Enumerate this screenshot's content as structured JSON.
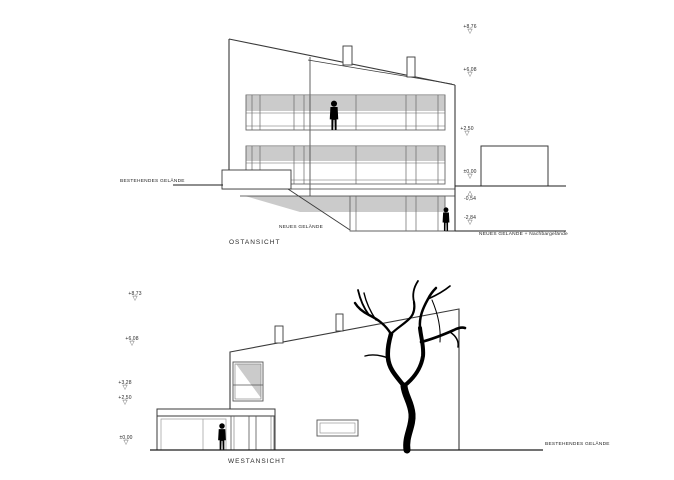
{
  "sheet": {
    "type": "architectural elevation drawings"
  },
  "glyphs": {
    "triangle_down": "▽",
    "triangle_up": "△"
  },
  "colors": {
    "background": "#ffffff",
    "line": "#444444",
    "shadow": "#cccccc",
    "silhouette": "#000000"
  },
  "east": {
    "title": "OSTANSICHT",
    "existing_ground_label": "BESTEHENDES GELÄNDE",
    "new_ground_label": "NEUES GELÄNDE",
    "new_ground_neighbor_label": "NEUES GELÄNDE + Nachbargelände",
    "markers": [
      {
        "value": "+8,76",
        "direction": "down"
      },
      {
        "value": "+6,08",
        "direction": "down"
      },
      {
        "value": "+2,50",
        "direction": "down"
      },
      {
        "value": "±0,00",
        "direction": "down"
      },
      {
        "value": "-0,54",
        "direction": "up"
      },
      {
        "value": "-2,84",
        "direction": "down"
      }
    ]
  },
  "west": {
    "title": "WESTANSICHT",
    "existing_ground_label": "BESTEHENDES GELÄNDE",
    "markers": [
      {
        "value": "+8,73",
        "direction": "down"
      },
      {
        "value": "+6,08",
        "direction": "down"
      },
      {
        "value": "+3,28",
        "direction": "down"
      },
      {
        "value": "+2,50",
        "direction": "down"
      },
      {
        "value": "±0,00",
        "direction": "down"
      }
    ]
  }
}
